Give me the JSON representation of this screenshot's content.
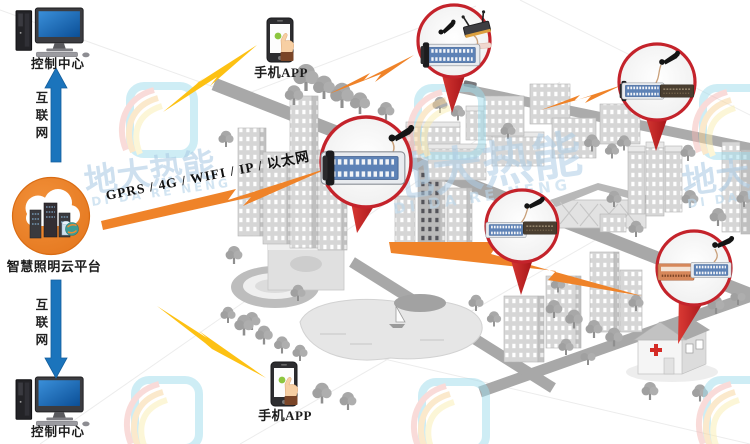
{
  "watermark": {
    "brand_cn": "地大热能",
    "brand_en": "DI DA RE NENG"
  },
  "left_column": {
    "control_center_top": "控制中心",
    "internet_top": "互联网",
    "cloud_platform": "智慧照明云平台",
    "internet_bottom": "互联网",
    "control_center_bottom": "控制中心"
  },
  "mobile": {
    "app_top": "手机APP",
    "app_bottom": "手机APP"
  },
  "network": {
    "protocols": "GPRS / 4G / WIFI / IP / 以太网"
  },
  "colors": {
    "cloud_orange": "#e8791d",
    "arrow_blue": "#1b74bc",
    "pin_red": "#c9252c",
    "bolt_orange": "#ef8329",
    "bolt_yellow": "#fdc113",
    "watermark_blue": "#aecde6",
    "city_gray": "#c9c9c9"
  }
}
